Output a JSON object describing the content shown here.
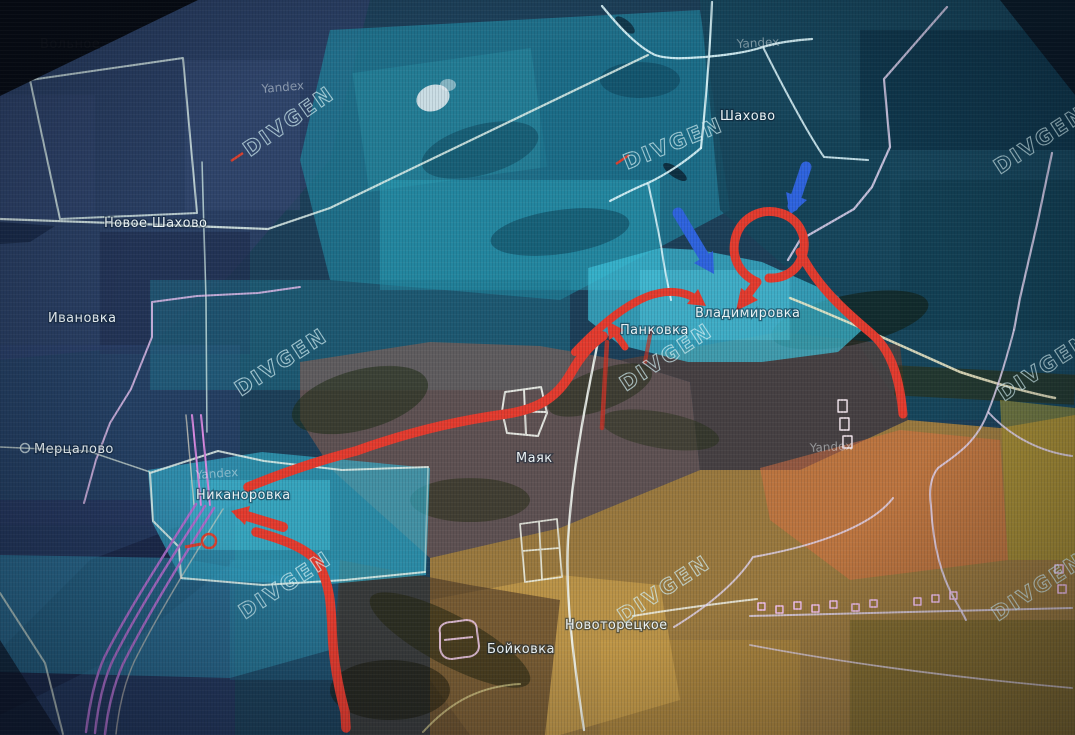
{
  "map": {
    "watermarks": {
      "overlay": "DIVGEN",
      "source": "Yandex"
    },
    "places": {
      "volnoye": "Вольное",
      "novoye_shakhovo": "Новое Шахово",
      "ivanovka": "Ивановка",
      "mertsalovo": "Мерцалово",
      "nikanorovka": "Никаноровка",
      "shakhovo": "Шахово",
      "pankovka": "Панковка",
      "vladimirovka": "Владимировка",
      "mayak": "Маяк",
      "novotoretskoye": "Новоторецкое",
      "boykovka": "Бойковка"
    },
    "colors": {
      "attack_arrow": "#e23b2e",
      "counter_arrow": "#2e63dd",
      "zone_cyan": "#3dc1da",
      "zone_cyan_west": "#34b2cf",
      "zone_orange": "#cb8f35",
      "zone_salmon": "#dd7040",
      "zone_maroon": "#96604f",
      "boundary": "#e2efe8",
      "road_pink": "#dcb8e6",
      "railway": "#a86cc8",
      "poi_red": "#d8402f"
    }
  }
}
